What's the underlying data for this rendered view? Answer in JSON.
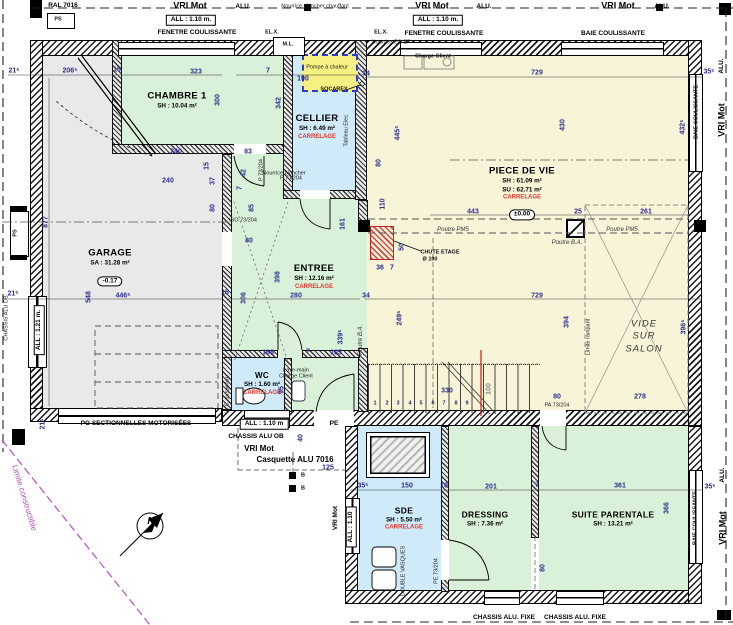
{
  "rooms": {
    "garage": {
      "name": "GARAGE",
      "area": "SA : 31.28 m²",
      "level": "-0.17"
    },
    "chambre1": {
      "name": "CHAMBRE 1",
      "area": "SH : 10.04 m²"
    },
    "cellier": {
      "name": "CELLIER",
      "area": "SH : 6.49 m²",
      "floor": "CARRELAGE"
    },
    "piece_de_vie": {
      "name": "PIECE DE VIE",
      "area": "SH : 61.09 m²",
      "area2": "SU : 62.71 m²",
      "floor": "CARRELAGE",
      "level": "±0.00"
    },
    "entree": {
      "name": "ENTREE",
      "area": "SH : 12.16 m²",
      "floor": "CARRELAGE"
    },
    "wc": {
      "name": "WC",
      "area": "SH : 1.60 m²",
      "floor": "CARRELAGE"
    },
    "sde": {
      "name": "SDE",
      "area": "SH : 5.50 m²",
      "floor": "CARRELAGE"
    },
    "dressing": {
      "name": "DRESSING",
      "area": "SH : 7.36 m²"
    },
    "suite_parentale": {
      "name": "SUITE PARENTALE",
      "area": "SH : 13.21 m²"
    },
    "vide": {
      "line1": "VIDE",
      "line2": "SUR",
      "line3": "SALON"
    }
  },
  "colors": {
    "room_green": "#d8f1d8",
    "room_blue": "#cfeaf8",
    "room_yellow": "#f8f4d8",
    "garage_gray": "#e9e9e9",
    "dim_blue": "#2d2f8f",
    "accent_red": "#e8372c",
    "limit_magenta": "#b44fc0",
    "pump_yellow": "#f6ef82"
  },
  "annotations": [
    {
      "t": "RAL 7016",
      "x": 63,
      "y": 6,
      "c": "lbl"
    },
    {
      "t": "PS",
      "x": 58,
      "y": 20,
      "c": "tinyb"
    },
    {
      "t": "VRI Mot",
      "x": 190,
      "y": 6,
      "c": "hdr"
    },
    {
      "t": "ALU.",
      "x": 243,
      "y": 7,
      "c": "lbl"
    },
    {
      "t": "ALL : 1.10 m.",
      "x": 191,
      "y": 20,
      "c": "box"
    },
    {
      "t": "FENETRE COULISSANTE",
      "x": 197,
      "y": 33,
      "c": "lbl"
    },
    {
      "t": "VRI Mot",
      "x": 432,
      "y": 6,
      "c": "hdr"
    },
    {
      "t": "ALU.",
      "x": 484,
      "y": 7,
      "c": "lbl"
    },
    {
      "t": "ALL : 1.10 m.",
      "x": 438,
      "y": 20,
      "c": "box"
    },
    {
      "t": "FENETRE COULISSANTE",
      "x": 444,
      "y": 34,
      "c": "lbl"
    },
    {
      "t": "VRI Mot",
      "x": 618,
      "y": 6,
      "c": "hdr"
    },
    {
      "t": "ALU.",
      "x": 662,
      "y": 7,
      "c": "lbl"
    },
    {
      "t": "BAIE COULISSANTE",
      "x": 613,
      "y": 34,
      "c": "lbl"
    },
    {
      "t": "Nourrice plancher chauffant",
      "x": 315,
      "y": 7,
      "c": "tiny"
    },
    {
      "t": "EL.X.",
      "x": 272,
      "y": 33,
      "c": "tinyb"
    },
    {
      "t": "EL.X.",
      "x": 381,
      "y": 33,
      "c": "tinyb"
    },
    {
      "t": "M.L.",
      "x": 288,
      "y": 45,
      "c": "tinyb"
    },
    {
      "t": "Nourrice EC-EF",
      "x": 391,
      "y": 43,
      "c": "tiny"
    },
    {
      "t": "Charge Client",
      "x": 433,
      "y": 57,
      "c": "tinyb"
    },
    {
      "t": "Pompe à chaleur",
      "x": 327,
      "y": 68,
      "c": "tiny"
    },
    {
      "t": "190",
      "x": 303,
      "y": 79,
      "c": "dim"
    },
    {
      "t": "SOCAREX",
      "x": 334,
      "y": 90,
      "c": "tinyb"
    },
    {
      "t": "34",
      "x": 366,
      "y": 74,
      "c": "dim"
    },
    {
      "t": "7",
      "x": 268,
      "y": 71,
      "c": "dim"
    },
    {
      "t": "35⁵",
      "x": 709,
      "y": 72,
      "c": "dim"
    },
    {
      "t": "ALU.",
      "x": 722,
      "y": 66,
      "r": -90,
      "c": "lbl"
    },
    {
      "t": "VRI Mot",
      "x": 722,
      "y": 120,
      "r": -90,
      "c": "hdr"
    },
    {
      "t": "BAIE COULISSANTE",
      "x": 697,
      "y": 112,
      "r": -90,
      "c": "tinyb"
    },
    {
      "t": "432⁵",
      "x": 683,
      "y": 127,
      "r": -90,
      "c": "dim"
    },
    {
      "t": "430",
      "x": 563,
      "y": 125,
      "r": -90,
      "c": "dim"
    },
    {
      "t": "729",
      "x": 537,
      "y": 73,
      "c": "dim"
    },
    {
      "t": "21⁵",
      "x": 14,
      "y": 71,
      "c": "dim"
    },
    {
      "t": "206⁵",
      "x": 70,
      "y": 71,
      "c": "dim"
    },
    {
      "t": "15",
      "x": 117,
      "y": 70,
      "c": "dim"
    },
    {
      "t": "323",
      "x": 196,
      "y": 72,
      "c": "dim"
    },
    {
      "t": "877",
      "x": 46,
      "y": 222,
      "r": -90,
      "c": "dim"
    },
    {
      "t": "300",
      "x": 218,
      "y": 100,
      "r": -90,
      "c": "dim"
    },
    {
      "t": "342",
      "x": 279,
      "y": 103,
      "r": -90,
      "c": "dim"
    },
    {
      "t": "445⁵",
      "x": 398,
      "y": 133,
      "r": -90,
      "c": "dim"
    },
    {
      "t": "240",
      "x": 176,
      "y": 152,
      "c": "dim"
    },
    {
      "t": "240",
      "x": 168,
      "y": 181,
      "c": "dim"
    },
    {
      "t": "83",
      "x": 248,
      "y": 152,
      "c": "dim"
    },
    {
      "t": "42",
      "x": 244,
      "y": 173,
      "r": -90,
      "c": "dim"
    },
    {
      "t": "7",
      "x": 240,
      "y": 188,
      "r": -90,
      "c": "dim"
    },
    {
      "t": "15",
      "x": 207,
      "y": 166,
      "r": -90,
      "c": "dim"
    },
    {
      "t": "37",
      "x": 213,
      "y": 181,
      "r": -90,
      "c": "dim"
    },
    {
      "t": "P 73/204",
      "x": 262,
      "y": 170,
      "r": -90,
      "c": "tiny"
    },
    {
      "t": "Nourrice plancher",
      "x": 284,
      "y": 174,
      "c": "tiny"
    },
    {
      "t": "80",
      "x": 213,
      "y": 208,
      "r": -90,
      "c": "dim"
    },
    {
      "t": "85",
      "x": 252,
      "y": 208,
      "r": -90,
      "c": "dim"
    },
    {
      "t": "ISO 73/204",
      "x": 243,
      "y": 221,
      "c": "tiny"
    },
    {
      "t": "80",
      "x": 249,
      "y": 241,
      "c": "dim"
    },
    {
      "t": "548",
      "x": 89,
      "y": 297,
      "r": -90,
      "c": "dim"
    },
    {
      "t": "446⁵",
      "x": 123,
      "y": 296,
      "c": "dim"
    },
    {
      "t": "21⁵",
      "x": 13,
      "y": 294,
      "c": "dim"
    },
    {
      "t": "15",
      "x": 225,
      "y": 293,
      "c": "dim"
    },
    {
      "t": "PS",
      "x": 16,
      "y": 233,
      "r": -90,
      "c": "tinyb"
    },
    {
      "t": "CHASSIS ALU DB",
      "x": 7,
      "y": 318,
      "r": -90,
      "c": "tiny"
    },
    {
      "t": "ALL : 1.21 m.",
      "x": 39,
      "y": 330,
      "r": -90,
      "c": "box"
    },
    {
      "t": "21⁵",
      "x": 43,
      "y": 424,
      "r": -90,
      "c": "dim"
    },
    {
      "t": "PG SECTIONNELLES MOTORISÉES",
      "x": 136,
      "y": 424,
      "c": "lbl"
    },
    {
      "t": "Tableau Elec.",
      "x": 347,
      "y": 130,
      "r": -90,
      "c": "tiny"
    },
    {
      "t": "P 73/204",
      "x": 291,
      "y": 179,
      "c": "tiny"
    },
    {
      "t": "398",
      "x": 278,
      "y": 277,
      "r": -90,
      "c": "dim"
    },
    {
      "t": "306",
      "x": 244,
      "y": 298,
      "r": -90,
      "c": "dim"
    },
    {
      "t": "280",
      "x": 296,
      "y": 296,
      "c": "dim"
    },
    {
      "t": "34",
      "x": 366,
      "y": 296,
      "c": "dim"
    },
    {
      "t": "161",
      "x": 343,
      "y": 224,
      "r": -90,
      "c": "dim"
    },
    {
      "t": "110",
      "x": 383,
      "y": 204,
      "r": -90,
      "c": "dim"
    },
    {
      "t": "80",
      "x": 379,
      "y": 163,
      "r": -90,
      "c": "dim"
    },
    {
      "t": "36",
      "x": 380,
      "y": 268,
      "c": "dim"
    },
    {
      "t": "7",
      "x": 392,
      "y": 268,
      "c": "dim"
    },
    {
      "t": "50",
      "x": 402,
      "y": 247,
      "r": -90,
      "c": "dim"
    },
    {
      "t": "339⁵",
      "x": 341,
      "y": 337,
      "r": -90,
      "c": "dim"
    },
    {
      "t": "249⁵",
      "x": 400,
      "y": 318,
      "r": -90,
      "c": "dim"
    },
    {
      "t": "Poutre B.A.",
      "x": 361,
      "y": 340,
      "r": -90,
      "c": "it"
    },
    {
      "t": "168",
      "x": 268,
      "y": 353,
      "c": "dim"
    },
    {
      "t": "7",
      "x": 308,
      "y": 352,
      "c": "dim"
    },
    {
      "t": "105",
      "x": 336,
      "y": 353,
      "c": "dim"
    },
    {
      "t": "CHUTE ETAGE",
      "x": 440,
      "y": 253,
      "c": "tinyb"
    },
    {
      "t": "Ø 100",
      "x": 430,
      "y": 260,
      "c": "tinyb"
    },
    {
      "t": "Lave-main",
      "x": 296,
      "y": 371,
      "c": "tiny"
    },
    {
      "t": "Charge Client",
      "x": 296,
      "y": 377,
      "c": "tiny"
    },
    {
      "t": "W.C. suspendu",
      "x": 228,
      "y": 394,
      "r": -90,
      "c": "tiny"
    },
    {
      "t": "95",
      "x": 282,
      "y": 390,
      "r": -90,
      "c": "dim"
    },
    {
      "t": "443",
      "x": 473,
      "y": 212,
      "c": "dim"
    },
    {
      "t": "25",
      "x": 578,
      "y": 212,
      "c": "dim"
    },
    {
      "t": "261",
      "x": 646,
      "y": 212,
      "c": "dim"
    },
    {
      "t": "Poutre PM5",
      "x": 453,
      "y": 230,
      "c": "it"
    },
    {
      "t": "Poutre PM5",
      "x": 622,
      "y": 230,
      "c": "it"
    },
    {
      "t": "Poutre B.A.",
      "x": 567,
      "y": 243,
      "c": "it"
    },
    {
      "t": "729",
      "x": 537,
      "y": 296,
      "c": "dim"
    },
    {
      "t": "394",
      "x": 567,
      "y": 322,
      "r": -90,
      "c": "dim"
    },
    {
      "t": "396⁵",
      "x": 684,
      "y": 327,
      "r": -90,
      "c": "dim"
    },
    {
      "t": "278",
      "x": 640,
      "y": 397,
      "c": "dim"
    },
    {
      "t": "Limite rampant",
      "x": 589,
      "y": 337,
      "r": -90,
      "c": "tiny"
    },
    {
      "t": "1",
      "x": 375,
      "y": 404,
      "c": "stp"
    },
    {
      "t": "2",
      "x": 387,
      "y": 404,
      "c": "stp"
    },
    {
      "t": "3",
      "x": 398,
      "y": 404,
      "c": "stp"
    },
    {
      "t": "4",
      "x": 410,
      "y": 404,
      "c": "stp"
    },
    {
      "t": "5",
      "x": 421,
      "y": 404,
      "c": "stp"
    },
    {
      "t": "6",
      "x": 433,
      "y": 404,
      "c": "stp"
    },
    {
      "t": "7",
      "x": 444,
      "y": 404,
      "c": "stp"
    },
    {
      "t": "8",
      "x": 456,
      "y": 404,
      "c": "stp"
    },
    {
      "t": "9",
      "x": 467,
      "y": 404,
      "c": "stp"
    },
    {
      "t": "330",
      "x": 447,
      "y": 391,
      "c": "dim"
    },
    {
      "t": "100",
      "x": 489,
      "y": 389,
      "r": -90,
      "c": "gray"
    },
    {
      "t": "80",
      "x": 557,
      "y": 397,
      "c": "dim"
    },
    {
      "t": "PA 73/204",
      "x": 557,
      "y": 406,
      "c": "tiny"
    },
    {
      "t": "ALL : 1.10 m",
      "x": 264,
      "y": 424,
      "c": "box"
    },
    {
      "t": "PE",
      "x": 334,
      "y": 424,
      "c": "lbl"
    },
    {
      "t": "CHASSIS ALU OB",
      "x": 256,
      "y": 437,
      "c": "lbl"
    },
    {
      "t": "VRI Mot",
      "x": 259,
      "y": 449,
      "c": "lbl2"
    },
    {
      "t": "Casquette ALU 7016",
      "x": 295,
      "y": 460,
      "c": "lbl2"
    },
    {
      "t": "125",
      "x": 328,
      "y": 468,
      "c": "dim"
    },
    {
      "t": "40",
      "x": 301,
      "y": 438,
      "r": -90,
      "c": "dim"
    },
    {
      "t": "B",
      "x": 303,
      "y": 476,
      "c": "tinyb"
    },
    {
      "t": "B",
      "x": 303,
      "y": 489,
      "c": "tinyb"
    },
    {
      "t": "35⁵",
      "x": 363,
      "y": 486,
      "c": "dim"
    },
    {
      "t": "VRI Mot",
      "x": 336,
      "y": 518,
      "r": -90,
      "c": "lbl"
    },
    {
      "t": "ALL : 1.10",
      "x": 351,
      "y": 527,
      "r": -90,
      "c": "box"
    },
    {
      "t": "150",
      "x": 407,
      "y": 486,
      "c": "dim"
    },
    {
      "t": "10",
      "x": 444,
      "y": 486,
      "c": "dim"
    },
    {
      "t": "DOUBLE VASQUES",
      "x": 404,
      "y": 571,
      "r": -90,
      "c": "tiny"
    },
    {
      "t": "PE 73/204",
      "x": 437,
      "y": 571,
      "r": -90,
      "c": "tiny"
    },
    {
      "t": "201",
      "x": 491,
      "y": 487,
      "c": "dim"
    },
    {
      "t": "7",
      "x": 537,
      "y": 485,
      "c": "dim"
    },
    {
      "t": "80",
      "x": 543,
      "y": 568,
      "r": -90,
      "c": "dim"
    },
    {
      "t": "361",
      "x": 620,
      "y": 486,
      "c": "dim"
    },
    {
      "t": "366",
      "x": 667,
      "y": 508,
      "r": -90,
      "c": "dim"
    },
    {
      "t": "35⁵",
      "x": 710,
      "y": 487,
      "c": "dim"
    },
    {
      "t": "BAIE COULISSANTE",
      "x": 696,
      "y": 518,
      "r": -90,
      "c": "tinyb"
    },
    {
      "t": "ALU.",
      "x": 723,
      "y": 475,
      "r": -90,
      "c": "lbl"
    },
    {
      "t": "VRI Mot",
      "x": 723,
      "y": 528,
      "r": -90,
      "c": "hdr"
    },
    {
      "t": "CHASSIS ALU. FIXE",
      "x": 504,
      "y": 618,
      "c": "lbl"
    },
    {
      "t": "CHASSIS ALU. FIXE",
      "x": 575,
      "y": 618,
      "c": "lbl"
    },
    {
      "t": "Limite constructible",
      "x": 24,
      "y": 498,
      "r": 73,
      "c": "pur"
    },
    {
      "t": "N",
      "x": 151,
      "y": 522,
      "c": "north"
    }
  ]
}
